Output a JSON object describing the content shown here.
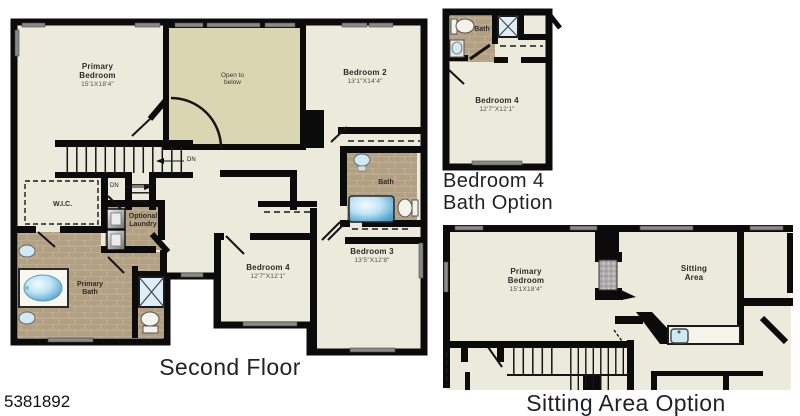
{
  "id_label": "5381892",
  "captions": {
    "main": "Second Floor",
    "bath_option_line1": "Bedroom 4",
    "bath_option_line2": "Bath Option",
    "sitting_option": "Sitting Area Option"
  },
  "colors": {
    "wall": "#0b0b0b",
    "floor": "#eceadb",
    "open_to_below_floor": "#dbd6b2",
    "tile_floor": "#b3a083",
    "window": "#8a8a8a",
    "water_fixture_blue": "#9fd2ec"
  },
  "main_plan": {
    "primary_bedroom": {
      "name_line1": "Primary",
      "name_line2": "Bedroom",
      "dims": "15'1X18'4\""
    },
    "open_to_below": {
      "line1": "Open to",
      "line2": "below"
    },
    "bedroom_2": {
      "name": "Bedroom 2",
      "dims": "13'1\"X14'4\""
    },
    "wic": {
      "name": "W.I.C."
    },
    "optional_laundry": {
      "line1": "Optional",
      "line2": "Laundry"
    },
    "primary_bath": {
      "line1": "Primary",
      "line2": "Bath"
    },
    "bath": {
      "name": "Bath"
    },
    "bedroom_4": {
      "name": "Bedroom 4",
      "dims": "12'7\"X12'1\""
    },
    "bedroom_3": {
      "name": "Bedroom 3",
      "dims": "13'5\"X12'8\""
    },
    "stair_label_upper": "DN",
    "stair_label_lower": "DN"
  },
  "bath_option_plan": {
    "bath": {
      "name": "Bath"
    },
    "bedroom_4": {
      "name": "Bedroom 4",
      "dims": "12'7\"X12'1\""
    }
  },
  "sitting_option_plan": {
    "primary_bedroom": {
      "name_line1": "Primary",
      "name_line2": "Bedroom",
      "dims": "15'1X18'4\""
    },
    "sitting_area": {
      "line1": "Sitting",
      "line2": "Area"
    }
  }
}
